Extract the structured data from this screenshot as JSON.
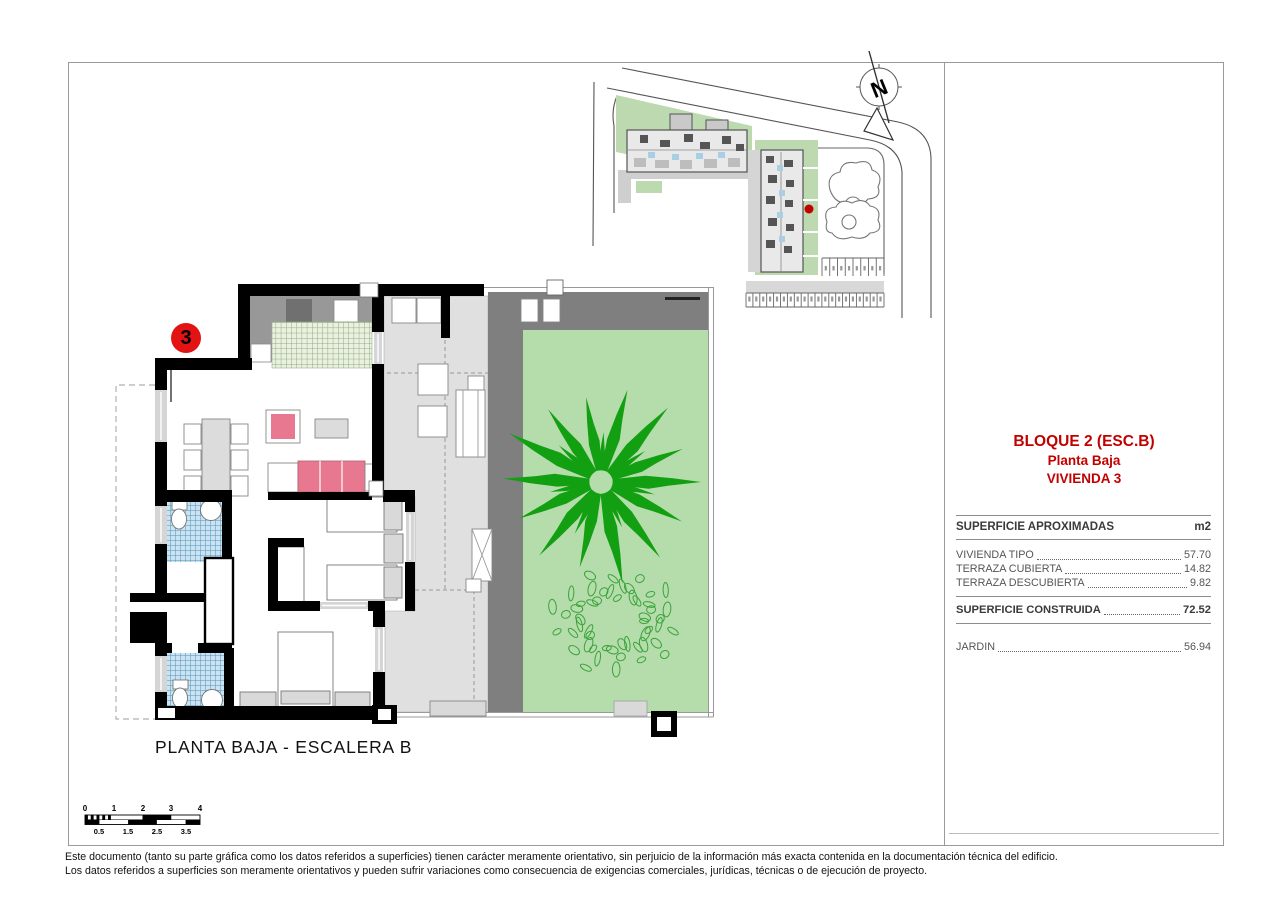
{
  "page": {
    "plan_title": "PLANTA BAJA - ESCALERA B",
    "unit_number": "3",
    "disclaimer_line1": "Este documento (tanto su parte gráfica como los datos referidos a superficies) tienen carácter meramente orientativo, sin perjuicio de la información más exacta contenida en la documentación técnica del edificio.",
    "disclaimer_line2": "Los datos referidos a superficies son meramente orientativos y pueden sufrir variaciones como consecuencia de exigencias comerciales, jurídicas, técnicas o de ejecución de proyecto."
  },
  "info_panel": {
    "block_title": "BLOQUE 2 (ESC.B)",
    "floor_label": "Planta Baja",
    "unit_label": "VIVIENDA 3",
    "areas": {
      "header": "SUPERFICIE APROXIMADAS",
      "unit_header": "m2",
      "rows": [
        {
          "label": "VIVIENDA TIPO",
          "value": "57.70"
        },
        {
          "label": "TERRAZA CUBIERTA",
          "value": "14.82"
        },
        {
          "label": "TERRAZA DESCUBIERTA",
          "value": "9.82"
        }
      ],
      "total_label": "SUPERFICIE CONSTRUIDA",
      "total_value": "72.52",
      "garden_label": "JARDIN",
      "garden_value": "56.94"
    }
  },
  "site_plan": {
    "north_label": "N"
  },
  "scale_bar": {
    "top_ticks": [
      "0",
      "1",
      "2",
      "3",
      "4"
    ],
    "bottom_ticks": [
      "0.5",
      "1.5",
      "2.5",
      "3.5"
    ]
  },
  "colors": {
    "accent_red": "#c30000",
    "marker_red": "#e31313",
    "garden_green": "#b5dcab",
    "palm_green": "#12a012",
    "bush_green": "#3aa33a",
    "terrace_gray": "#e0e0e0",
    "pergola_gray": "#7f7f7f",
    "furniture_pink": "#e8788f",
    "site_green": "#bcd9b0"
  }
}
